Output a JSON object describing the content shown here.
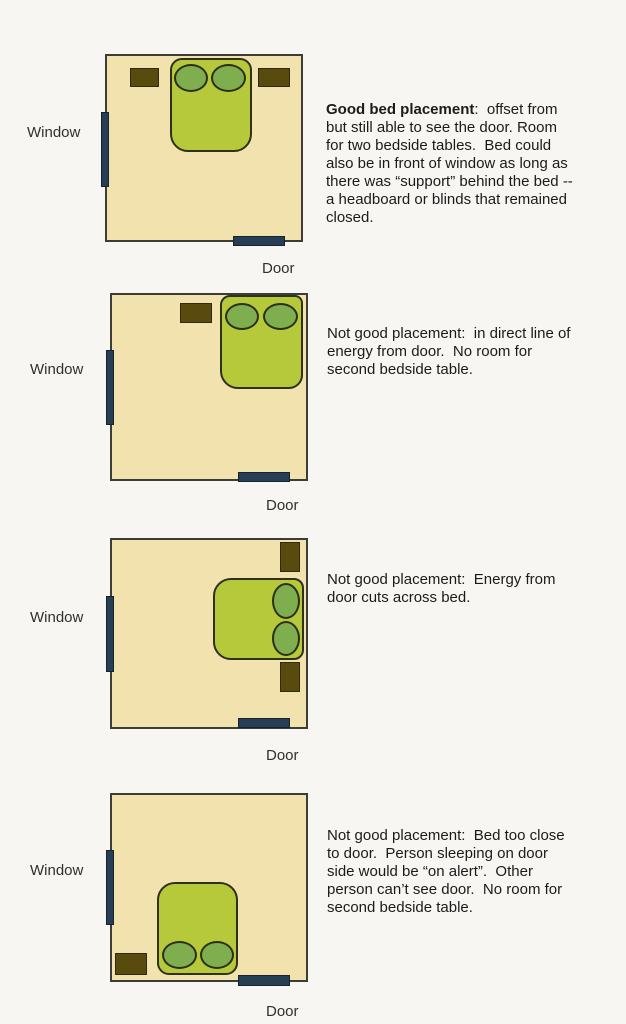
{
  "colors": {
    "background": "#f7f6f3",
    "room_fill": "#f2e2ae",
    "room_border": "#3d3d38",
    "bed_fill": "#b5c93b",
    "pillow_fill": "#7fae4e",
    "nightstand_fill": "#594a0d",
    "window_door_fill": "#273f55",
    "label_text": "#2f2f2f",
    "caption_text": "#1b1b1b"
  },
  "diagrams": [
    {
      "id": "good-placement",
      "quality": "good",
      "window_label": "Window",
      "door_label": "Door",
      "bed_position": "top-center offset from door, two bedside tables",
      "caption_lines": [
        {
          "bold": "Good bed placement",
          "text": ":  offset from"
        },
        {
          "text": "but still able to see the door. Room"
        },
        {
          "text": "for two bedside tables.  Bed could"
        },
        {
          "text": "also be in front of window as long as"
        },
        {
          "text": "there was “support” behind the bed --"
        },
        {
          "text": "a headboard or blinds that remained"
        },
        {
          "text": "closed."
        }
      ]
    },
    {
      "id": "direct-line-of-energy",
      "quality": "not-good",
      "window_label": "Window",
      "door_label": "Door",
      "bed_position": "top-right corner in line with door, one bedside table",
      "caption_lines": [
        {
          "text": "Not good placement:  in direct line of"
        },
        {
          "text": "energy from door.  No room for"
        },
        {
          "text": "second bedside table."
        }
      ]
    },
    {
      "id": "energy-cuts-across-bed",
      "quality": "not-good",
      "window_label": "Window",
      "door_label": "Door",
      "bed_position": "right wall sideways, pillows against right wall, two bedside tables",
      "caption_lines": [
        {
          "text": "Not good placement:  Energy from"
        },
        {
          "text": "door cuts across bed."
        }
      ]
    },
    {
      "id": "bed-too-close-to-door",
      "quality": "not-good",
      "window_label": "Window",
      "door_label": "Door",
      "bed_position": "bottom-center next to door, pillows at bottom wall, one bedside table",
      "caption_lines": [
        {
          "text": "Not good placement:  Bed too close"
        },
        {
          "text": "to door.  Person sleeping on door"
        },
        {
          "text": "side would be “on alert”.  Other"
        },
        {
          "text": "person can’t see door.  No room for"
        },
        {
          "text": "second bedside table."
        }
      ]
    }
  ]
}
